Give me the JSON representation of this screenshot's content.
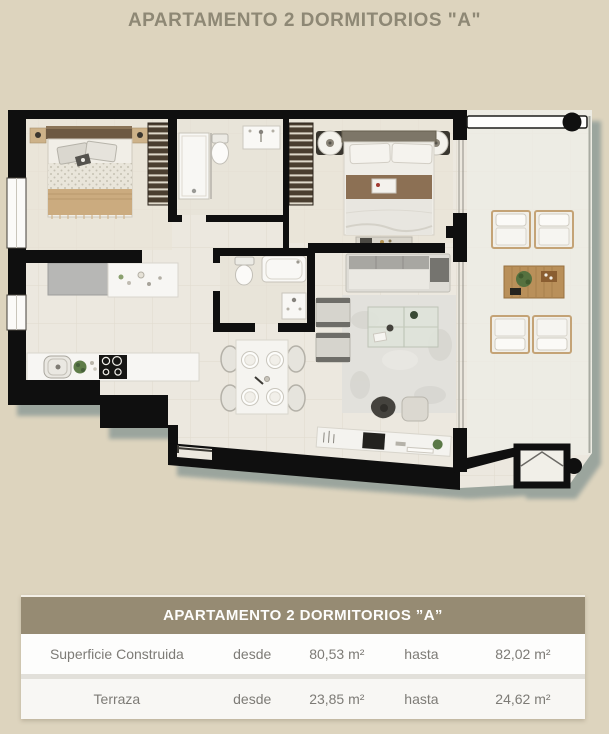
{
  "page": {
    "title": "APARTAMENTO 2 DORMITORIOS \"A\""
  },
  "floorplan": {
    "description_colors": {
      "page_bg": "#ddd4be",
      "title_color": "#8e8875",
      "wall": "#0f0f0f",
      "floor": "#ece8df",
      "bedroom_floor": "#e9e3d6",
      "shadow": "#98a39c",
      "wood": "#b9905a",
      "bed_throw": "#cbab7f",
      "blanket_brown": "#8c7054"
    }
  },
  "table": {
    "title": "APARTAMENTO 2 DORMITORIOS ”A”",
    "rows": [
      {
        "label": "Superficie Construida",
        "from_word": "desde",
        "from_value": "80,53 m²",
        "to_word": "hasta",
        "to_value": "82,02 m²"
      },
      {
        "label": "Terraza",
        "from_word": "desde",
        "from_value": "23,85 m²",
        "to_word": "hasta",
        "to_value": "24,62 m²"
      }
    ]
  }
}
